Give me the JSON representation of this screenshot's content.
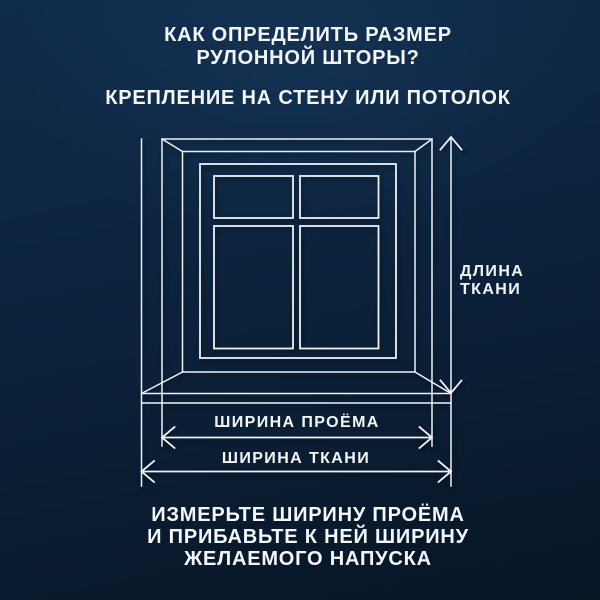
{
  "title": "КАК ОПРЕДЕЛИТЬ РАЗМЕР\nРУЛОННОЙ ШТОРЫ?",
  "subtitle": "КРЕПЛЕНИЕ НА СТЕНУ ИЛИ ПОТОЛОК",
  "diagram": {
    "fabric_length_label": "ДЛИНА\nТКАНИ",
    "opening_width_label": "ШИРИНА ПРОЁМА",
    "fabric_width_label": "ШИРИНА ТКАНИ"
  },
  "footer": "ИЗМЕРЬТЕ ШИРИНУ ПРОЁМА\nИ ПРИБАВЬТЕ К НЕЙ ШИРИНУ\nЖЕЛАЕМОГО НАПУСКА",
  "colors": {
    "background_top": "#0f2b4a",
    "background_bottom": "#071525",
    "line": "#eef2f6",
    "text": "#f3f6fa"
  }
}
